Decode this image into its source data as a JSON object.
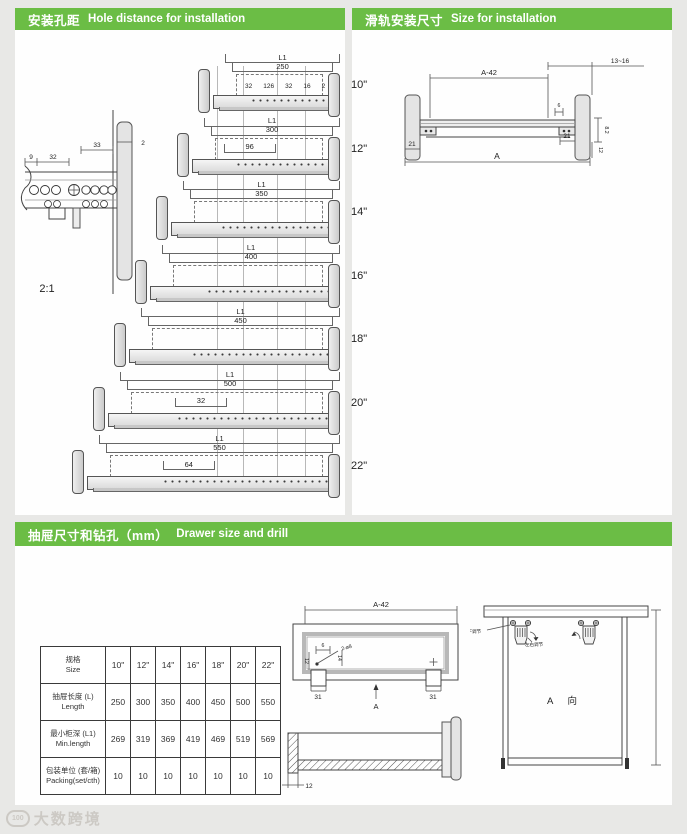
{
  "page": {
    "accent": "#6bbd45",
    "bg": "#e8e8e6"
  },
  "sections": {
    "hole_distance": {
      "title_zh": "安装孔距",
      "title_en": "Hole distance for installation"
    },
    "size_install": {
      "title_zh": "滑轨安装尺寸",
      "title_en": "Size for installation"
    },
    "drawer_drill": {
      "title_zh": "抽屉尺寸和钻孔（mm）",
      "title_en": "Drawer size and drill"
    }
  },
  "hole_distance": {
    "scale_label": "2:1",
    "detail_dims": {
      "d9": "9",
      "d32": "32",
      "d33": "33",
      "d2": "2"
    },
    "l1_label": "L1",
    "slides": [
      {
        "size": "10\"",
        "length": "250",
        "dims": [
          "32",
          "126",
          "32",
          "16",
          "2"
        ]
      },
      {
        "size": "12\"",
        "length": "300",
        "dims": [
          "96"
        ]
      },
      {
        "size": "14\"",
        "length": "350"
      },
      {
        "size": "16\"",
        "length": "400"
      },
      {
        "size": "18\"",
        "length": "450"
      },
      {
        "size": "20\"",
        "length": "500",
        "dims": [
          "32"
        ]
      },
      {
        "size": "22\"",
        "length": "550",
        "dims": [
          "64"
        ]
      }
    ]
  },
  "size_install": {
    "dims": {
      "a42": "A-42",
      "range": "13~16",
      "d6": "6",
      "left21": "21",
      "right21": "21",
      "a": "A",
      "v1": "8.2",
      "v2": "12"
    }
  },
  "drawer_drill": {
    "table": {
      "rows": [
        {
          "zh": "规格",
          "en": "Size",
          "values": [
            "10\"",
            "12\"",
            "14\"",
            "16\"",
            "18\"",
            "20\"",
            "22\""
          ]
        },
        {
          "zh": "抽屉长度 (L)",
          "en": "Length",
          "values": [
            "250",
            "300",
            "350",
            "400",
            "450",
            "500",
            "550"
          ]
        },
        {
          "zh": "最小柜深 (L1)",
          "en": "Min.length",
          "values": [
            "269",
            "319",
            "369",
            "419",
            "469",
            "519",
            "569"
          ]
        },
        {
          "zh": "包装单位 (套/箱)",
          "en": "Packing(set/cth)",
          "values": [
            "10",
            "10",
            "10",
            "10",
            "10",
            "10",
            "10"
          ]
        }
      ]
    },
    "plan": {
      "a42": "A-42",
      "d6": "6",
      "holes": "2-ø8",
      "left31": "31",
      "right31": "31",
      "view": "A",
      "v1": "12",
      "v2": "14"
    },
    "section": {
      "d12": "12"
    },
    "view_a": {
      "label": "A  向",
      "adj1": "上下调节",
      "adj2": "左右调节"
    }
  },
  "watermark": {
    "logo": "100",
    "text": "大数跨境"
  }
}
